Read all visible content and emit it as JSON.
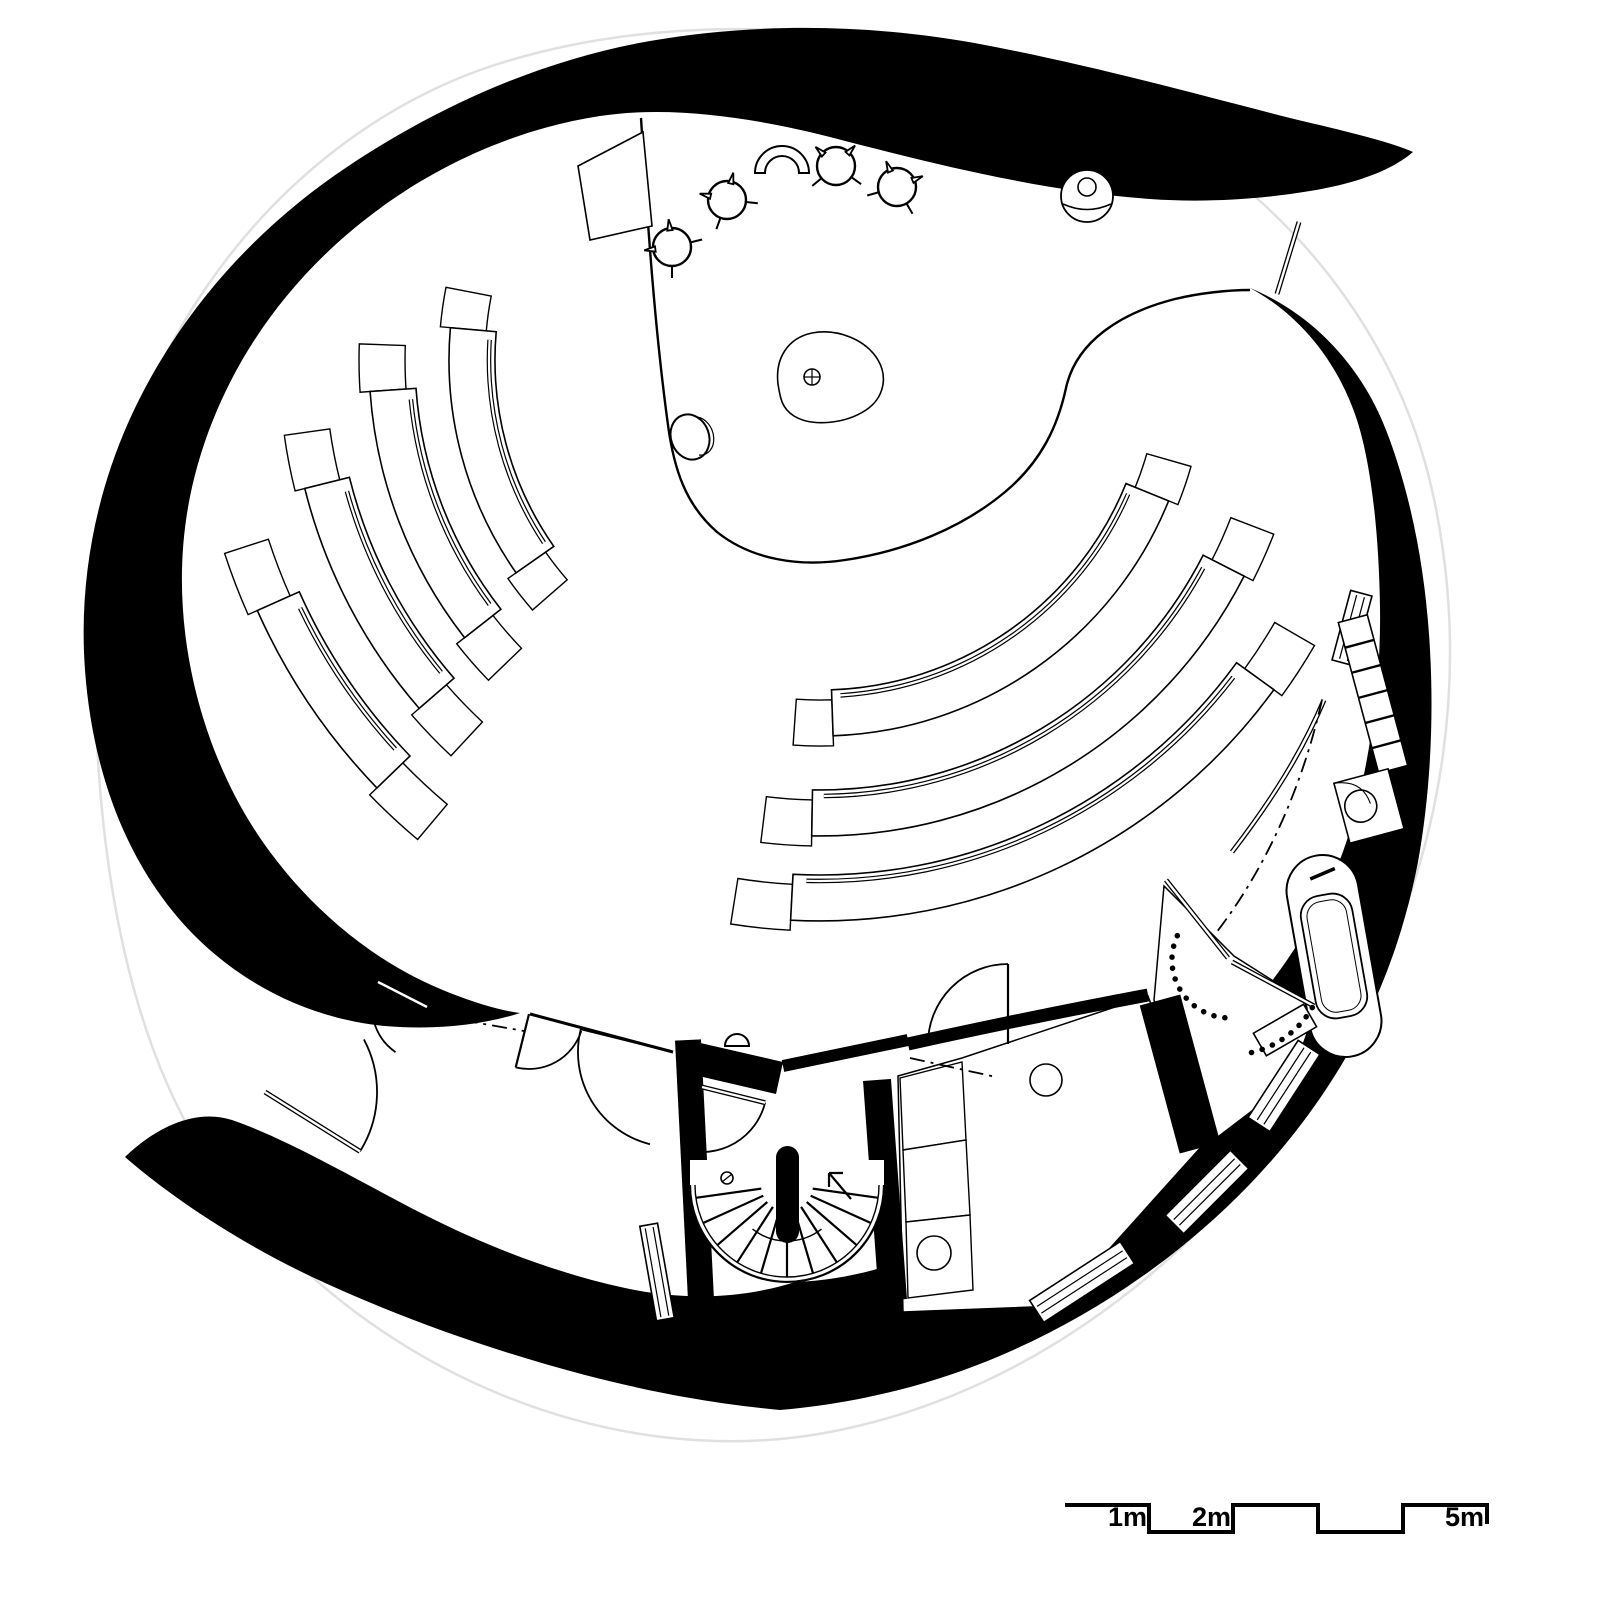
{
  "page": {
    "background": "#ffffff",
    "ink": "#000000",
    "guide_color": "#e0e0e0"
  },
  "scale_bar": {
    "labels": {
      "one": "1m",
      "two": "2m",
      "five": "5m"
    },
    "path": "M 1065,1505 L 1149,1505 L 1149,1532 L 1233,1532 L 1233,1505 L 1318,1505 L 1318,1532 L 1403,1532 L 1403,1505 L 1487,1505 L 1487,1524",
    "stroke": 4
  },
  "drawing": {
    "guide": {
      "d": "M 95,640 C 98,380 260,150 480,70 C 640,14 820,22 980,55 C 1180,98 1380,260 1432,490 C 1470,660 1450,850 1350,1030 C 1240,1230 1050,1390 830,1432 C 620,1472 380,1380 230,1190 C 130,1065 93,860 95,640 Z",
      "w": 2.5
    },
    "walls": [
      {
        "name": "outer-wall-north",
        "d": "M 1413,152 C 1392,170 1358,183 1310,191 C 1262,199 1205,203 1150,199 C 1040,191 930,163 830,137 C 755,118 672,105 600,116 C 520,128 440,163 375,212 C 300,268 245,340 213,420 C 184,492 176,565 186,640 C 196,714 224,790 270,852 C 316,914 378,965 450,993 C 478,1004 503,1011 520,1013 C 480,1026 432,1030 385,1026 C 310,1019 235,983 180,920 C 122,853 92,765 85,670 C 78,575 98,478 143,392 C 190,302 260,225 347,167 C 435,108 540,60 650,41 C 760,22 875,24 985,45 C 1095,66 1200,95 1290,118 C 1340,130 1385,140 1413,152 Z"
      },
      {
        "name": "outer-wall-south",
        "d": "M 1250,288 C 1300,315 1338,362 1357,420 C 1372,467 1379,538 1380,607 C 1381,676 1372,748 1355,813 C 1340,870 1315,920 1285,963 C 1252,1010 1210,1058 1162,1098 C 1110,1145 1052,1188 990,1222 C 930,1255 862,1280 795,1282 C 738,1300 680,1300 625,1288 C 560,1274 490,1248 425,1215 C 360,1182 290,1140 232,1120 C 195,1108 155,1128 125,1157 C 170,1196 235,1240 310,1276 C 395,1316 490,1350 585,1375 C 650,1392 715,1404 780,1410 C 850,1404 920,1388 985,1362 C 1055,1334 1120,1296 1180,1248 C 1245,1196 1300,1134 1342,1064 C 1378,1004 1404,935 1418,862 C 1430,795 1434,722 1430,650 C 1426,574 1412,497 1386,430 C 1362,368 1315,315 1250,288 Z"
      },
      {
        "name": "stair-junction-wall",
        "d": "M 696,1042 L 783,1062 L 776,1094 L 690,1074 Z"
      }
    ],
    "white_rooms": [
      {
        "name": "service-room",
        "d": "M 898,1076 L 962,1058 L 1148,996 L 1202,1146 L 1058,1306 L 903,1312 Z"
      },
      {
        "name": "bathroom",
        "d": "M 1164,886 L 1234,956 L 1316,1008 L 1290,1082 L 1206,1146 L 1154,1000 Z"
      }
    ],
    "partitions": [
      {
        "name": "stair-wall-west",
        "d": "M 688,1040 L 701,1300",
        "w": 26
      },
      {
        "name": "stair-wall-east",
        "d": "M 877,1080 L 893,1300",
        "w": 28
      },
      {
        "name": "room-partition",
        "d": "M 1160,1000 L 1200,1148",
        "w": 42
      },
      {
        "name": "lobby-wall",
        "d": "M 783,1066 L 908,1040",
        "w": 12
      },
      {
        "name": "corridor-wall",
        "d": "M 908,1044 C 990,1026 1068,1010 1148,995",
        "w": 13
      }
    ],
    "bump": {
      "d": "M 725,1046 A 12 12 0 0 1 749,1046 Z"
    },
    "windows": [
      {
        "name": "window-stair-west",
        "x": 657,
        "y": 1272,
        "len": 96,
        "w": 18,
        "rot": 80
      },
      {
        "name": "window-south-1",
        "x": 1082,
        "y": 1282,
        "len": 108,
        "w": 26,
        "rot": -33
      },
      {
        "name": "window-south-2",
        "x": 1207,
        "y": 1192,
        "len": 92,
        "w": 26,
        "rot": -45
      },
      {
        "name": "window-south-3",
        "x": 1284,
        "y": 1086,
        "len": 92,
        "w": 26,
        "rot": -57
      },
      {
        "name": "window-east",
        "x": 1352,
        "y": 628,
        "len": 72,
        "w": 22,
        "rot": -75
      }
    ],
    "ladder": {
      "x": 1373,
      "y": 694,
      "rot": -15,
      "w": 30,
      "len": 156,
      "rungs": 5
    },
    "sinkbox": {
      "x": 1369,
      "y": 806,
      "rot": -15,
      "w": 56,
      "h": 62,
      "circle": {
        "dx": -8,
        "dy": -2,
        "r": 16
      }
    },
    "tub": {
      "x": 1334,
      "y": 956,
      "rot": -10,
      "niche": {
        "w": 72,
        "h": 204,
        "rx": 36
      },
      "outer": {
        "w": 52,
        "h": 124,
        "rx": 20
      },
      "inner": {
        "w": 40,
        "h": 112,
        "rx": 15
      },
      "faucet": "M -10,-80 L 16,-86"
    },
    "smallrect": {
      "x": 1285,
      "y": 1030,
      "rot": -30,
      "w": 58,
      "h": 26
    },
    "counters": [
      {
        "d": "M 900,1078 L 962,1062 L 966,1140 L 903,1150 Z"
      },
      {
        "d": "M 903,1150 L 966,1140 L 970,1215 L 906,1222 Z"
      },
      {
        "d": "M 906,1222 L 970,1215 L 973,1290 L 908,1298 Z"
      }
    ],
    "circles": [
      {
        "name": "sink",
        "x": 934,
        "y": 1253,
        "r": 17
      },
      {
        "name": "basin",
        "x": 1046,
        "y": 1080,
        "r": 16
      }
    ],
    "thin": [
      {
        "name": "vestibule-wall",
        "d": "M 530,1014 L 673,1052",
        "w": 3
      },
      {
        "name": "entry-glazing",
        "d": "M 1299,222 L 1277,294",
        "dbl": true
      },
      {
        "name": "bath-partition-a",
        "d": "M 1166,880 L 1228,958",
        "dbl": true
      },
      {
        "name": "bath-partition-b",
        "d": "M 1232,962 L 1314,1006",
        "dbl": true
      },
      {
        "name": "corridor-glazing",
        "d": "M 1232,852 C 1272,800 1302,752 1324,700",
        "dbl": true
      }
    ],
    "dashdot": [
      {
        "d": "M 433,1015 L 524,1031"
      },
      {
        "d": "M 910,1058 L 996,1077"
      },
      {
        "d": "M 1322,700 C 1302,788 1266,868 1216,933"
      }
    ],
    "dotted": [
      {
        "c": {
          "x": 1230,
          "y": 960
        },
        "r": 58,
        "a0": 95,
        "a1": 205
      },
      {
        "c": {
          "x": 1230,
          "y": 960
        },
        "r": 95,
        "a0": 30,
        "a1": 78
      }
    ],
    "chancel": {
      "d": "M 641,118 C 648,230 655,330 668,425 C 674,470 686,505 717,532 C 752,560 800,567 845,560 C 905,551 962,528 1005,492 C 1042,461 1058,425 1066,388 C 1076,342 1120,313 1175,299 C 1200,293 1228,290 1250,290",
      "w": 2.4
    },
    "benches": {
      "center": {
        "x": 820,
        "y": 360
      },
      "seat": 46,
      "stub": {
        "deg": 6,
        "out": 10
      },
      "left": [
        {
          "r": 325,
          "a0": 145,
          "a1": 185
        },
        {
          "r": 405,
          "a0": 142,
          "a1": 176
        },
        {
          "r": 485,
          "a0": 139,
          "a1": 166
        },
        {
          "r": 570,
          "a0": 136,
          "a1": 156
        }
      ],
      "right": [
        {
          "r": 330,
          "a0": 22,
          "a1": 88
        },
        {
          "r": 430,
          "a0": 27,
          "a1": 91
        },
        {
          "r": 515,
          "a0": 36,
          "a1": 93
        }
      ]
    },
    "chairs": [
      {
        "x": 672,
        "y": 247,
        "f": 38
      },
      {
        "x": 727,
        "y": 200,
        "f": 58
      },
      {
        "x": 836,
        "y": 166,
        "f": 88
      },
      {
        "x": 897,
        "y": 187,
        "f": 112
      }
    ],
    "arch_chair": {
      "d": "M 755,173 A 27 27 0 0 1 809,173 L 799,173 A 17 17 0 0 0 765,173 Z"
    },
    "person_token": {
      "x": 1087,
      "y": 196,
      "r": 26,
      "head_r": 9,
      "chord": "M 1063,204 Q 1087,215 1111,204"
    },
    "altar": {
      "d": "M 778,384 C 775,358 788,338 812,333 C 838,328 866,340 878,360 C 888,377 884,398 866,410 C 845,424 812,427 794,416 C 781,408 780,396 778,384 Z",
      "cx": 812,
      "cy": 377,
      "r": 8
    },
    "font": {
      "x": 690,
      "y": 437,
      "rx": 19,
      "ry": 23,
      "rot": -20,
      "crescent": "M 697,417 A 14 18 -20 0 1 699,455"
    },
    "pulpit": {
      "d": "M 578,166 L 643,132 L 652,226 L 590,240 Z"
    },
    "stair": {
      "cx": 787,
      "cy": 1185,
      "rOut": 97,
      "rIn": 92,
      "rHub": 26,
      "rStep": 92,
      "midR": 56,
      "midA0": 52,
      "midA1": 128,
      "stepA0": 8,
      "stepA1": 172,
      "nSteps": 11,
      "newel": {
        "x": 776,
        "y": 1146,
        "w": 23,
        "h": 97
      },
      "post": {
        "x": 727,
        "y": 1178,
        "r": 6
      },
      "arrow": "M 851,1199 L 829,1173 M 829,1187 L 829,1173 M 829,1173 L 843,1173"
    },
    "doors": [
      {
        "name": "entry-door-outer",
        "h": {
          "x": 265,
          "y": 1092
        },
        "r": 112,
        "a0": -28,
        "a1": 32,
        "leafAt": 32,
        "dbl": true
      },
      {
        "name": "entry-door-wall",
        "h": {
          "x": 427,
          "y": 1007
        },
        "r": 55,
        "a0": 125,
        "a1": 207,
        "leafAt": 207,
        "dbl": true
      },
      {
        "name": "vestibule-door-1",
        "h": {
          "x": 529,
          "y": 1014
        },
        "r": 55,
        "a0": 18,
        "a1": 104,
        "leafAt": 104
      },
      {
        "name": "vestibule-door-2",
        "h": {
          "x": 673,
          "y": 1052
        },
        "r": 95,
        "a0": 104,
        "a1": 194,
        "leafAt": 194
      },
      {
        "name": "stair-lobby-door",
        "h": {
          "x": 702,
          "y": 1087
        },
        "r": 65,
        "a0": 14,
        "a1": 105,
        "leafAt": 14,
        "dbl": true
      },
      {
        "name": "service-room-door",
        "h": {
          "x": 1008,
          "y": 1044
        },
        "r": 80,
        "a0": 180,
        "a1": 270,
        "leafAt": 270
      }
    ]
  }
}
